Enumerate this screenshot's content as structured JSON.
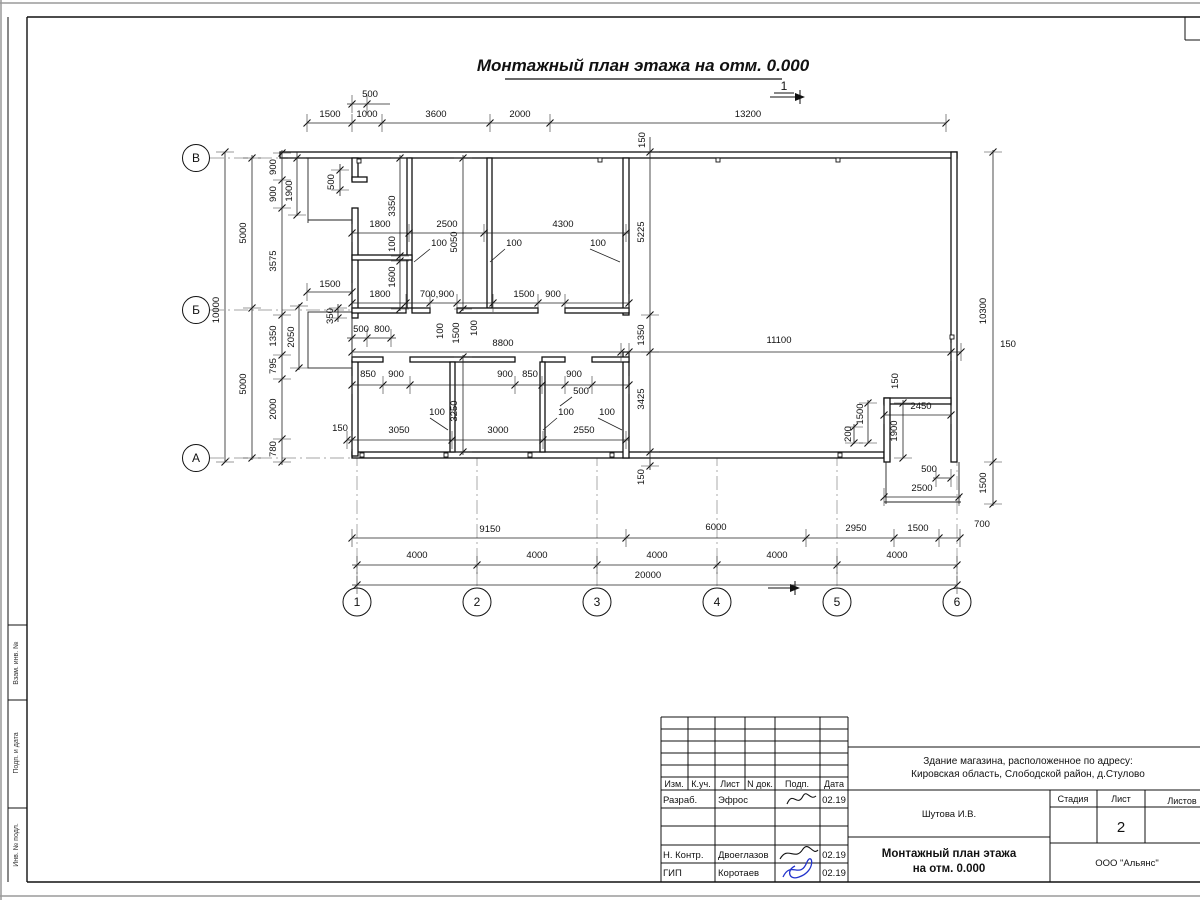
{
  "title": "Монтажный план этажа на отм. 0.000",
  "section_mark": "1",
  "axes": {
    "cols": [
      "1",
      "2",
      "3",
      "4",
      "5",
      "6"
    ],
    "rows": [
      "В",
      "Б",
      "А"
    ]
  },
  "dimensions": [
    {
      "t": "500",
      "x": 370,
      "y": 97,
      "v": false
    },
    {
      "t": "1500",
      "x": 330,
      "y": 117,
      "v": false
    },
    {
      "t": "1000",
      "x": 367,
      "y": 117,
      "v": false
    },
    {
      "t": "3600",
      "x": 436,
      "y": 117,
      "v": false
    },
    {
      "t": "2000",
      "x": 520,
      "y": 117,
      "v": false
    },
    {
      "t": "13200",
      "x": 748,
      "y": 117,
      "v": false
    },
    {
      "t": "150",
      "x": 645,
      "y": 140,
      "v": true
    },
    {
      "t": "10000",
      "x": 219,
      "y": 310,
      "v": true
    },
    {
      "t": "5000",
      "x": 246,
      "y": 233,
      "v": true
    },
    {
      "t": "5000",
      "x": 246,
      "y": 384,
      "v": true
    },
    {
      "t": "900",
      "x": 276,
      "y": 167,
      "v": true
    },
    {
      "t": "900",
      "x": 276,
      "y": 194,
      "v": true
    },
    {
      "t": "1900",
      "x": 292,
      "y": 191,
      "v": true
    },
    {
      "t": "3575",
      "x": 276,
      "y": 261,
      "v": true
    },
    {
      "t": "1350",
      "x": 276,
      "y": 336,
      "v": true
    },
    {
      "t": "795",
      "x": 276,
      "y": 366,
      "v": true
    },
    {
      "t": "2000",
      "x": 276,
      "y": 409,
      "v": true
    },
    {
      "t": "780",
      "x": 276,
      "y": 449,
      "v": true
    },
    {
      "t": "2050",
      "x": 294,
      "y": 337,
      "v": true
    },
    {
      "t": "1500",
      "x": 330,
      "y": 287,
      "v": false
    },
    {
      "t": "350",
      "x": 333,
      "y": 316,
      "v": true
    },
    {
      "t": "500",
      "x": 334,
      "y": 182,
      "v": true
    },
    {
      "t": "500",
      "x": 361,
      "y": 332,
      "v": false
    },
    {
      "t": "800",
      "x": 382,
      "y": 332,
      "v": false
    },
    {
      "t": "1800",
      "x": 380,
      "y": 227,
      "v": false
    },
    {
      "t": "2500",
      "x": 447,
      "y": 227,
      "v": false
    },
    {
      "t": "100",
      "x": 439,
      "y": 246,
      "v": false
    },
    {
      "t": "4300",
      "x": 563,
      "y": 227,
      "v": false
    },
    {
      "t": "100",
      "x": 514,
      "y": 246,
      "v": false
    },
    {
      "t": "100",
      "x": 598,
      "y": 246,
      "v": false
    },
    {
      "t": "3350",
      "x": 395,
      "y": 206,
      "v": true
    },
    {
      "t": "100",
      "x": 395,
      "y": 244,
      "v": true
    },
    {
      "t": "1600",
      "x": 395,
      "y": 277,
      "v": true
    },
    {
      "t": "5050",
      "x": 457,
      "y": 242,
      "v": true
    },
    {
      "t": "5225",
      "x": 644,
      "y": 232,
      "v": true
    },
    {
      "t": "1800",
      "x": 380,
      "y": 297,
      "v": false
    },
    {
      "t": "700,900",
      "x": 437,
      "y": 297,
      "v": false
    },
    {
      "t": "1500",
      "x": 524,
      "y": 297,
      "v": false
    },
    {
      "t": "900",
      "x": 553,
      "y": 297,
      "v": false
    },
    {
      "t": "100",
      "x": 443,
      "y": 331,
      "v": true
    },
    {
      "t": "1500",
      "x": 459,
      "y": 333,
      "v": true
    },
    {
      "t": "100",
      "x": 477,
      "y": 328,
      "v": true
    },
    {
      "t": "8800",
      "x": 503,
      "y": 346,
      "v": false
    },
    {
      "t": "11100",
      "x": 779,
      "y": 343,
      "v": false
    },
    {
      "t": "150",
      "x": 1008,
      "y": 347,
      "v": false
    },
    {
      "t": "1350",
      "x": 644,
      "y": 335,
      "v": true
    },
    {
      "t": "3425",
      "x": 644,
      "y": 399,
      "v": true
    },
    {
      "t": "150",
      "x": 644,
      "y": 477,
      "v": true
    },
    {
      "t": "10300",
      "x": 986,
      "y": 311,
      "v": true
    },
    {
      "t": "850",
      "x": 368,
      "y": 377,
      "v": false
    },
    {
      "t": "900",
      "x": 396,
      "y": 377,
      "v": false
    },
    {
      "t": "900",
      "x": 505,
      "y": 377,
      "v": false
    },
    {
      "t": "850",
      "x": 530,
      "y": 377,
      "v": false
    },
    {
      "t": "900",
      "x": 574,
      "y": 377,
      "v": false
    },
    {
      "t": "500",
      "x": 581,
      "y": 394,
      "v": false
    },
    {
      "t": "150",
      "x": 340,
      "y": 431,
      "v": false
    },
    {
      "t": "3050",
      "x": 399,
      "y": 433,
      "v": false
    },
    {
      "t": "100",
      "x": 437,
      "y": 415,
      "v": false
    },
    {
      "t": "3000",
      "x": 498,
      "y": 433,
      "v": false
    },
    {
      "t": "100",
      "x": 566,
      "y": 415,
      "v": false
    },
    {
      "t": "100",
      "x": 607,
      "y": 415,
      "v": false
    },
    {
      "t": "2550",
      "x": 584,
      "y": 433,
      "v": false
    },
    {
      "t": "3250",
      "x": 457,
      "y": 411,
      "v": true
    },
    {
      "t": "150",
      "x": 898,
      "y": 381,
      "v": true
    },
    {
      "t": "2450",
      "x": 921,
      "y": 409,
      "v": false
    },
    {
      "t": "1500",
      "x": 863,
      "y": 414,
      "v": true
    },
    {
      "t": "200",
      "x": 851,
      "y": 434,
      "v": true
    },
    {
      "t": "1900",
      "x": 897,
      "y": 431,
      "v": true
    },
    {
      "t": "500",
      "x": 929,
      "y": 472,
      "v": false
    },
    {
      "t": "2500",
      "x": 922,
      "y": 491,
      "v": false
    },
    {
      "t": "1500",
      "x": 986,
      "y": 483,
      "v": true
    },
    {
      "t": "2950",
      "x": 856,
      "y": 531,
      "v": false
    },
    {
      "t": "1500",
      "x": 918,
      "y": 531,
      "v": false
    },
    {
      "t": "700",
      "x": 982,
      "y": 527,
      "v": false
    },
    {
      "t": "9150",
      "x": 490,
      "y": 532,
      "v": false
    },
    {
      "t": "6000",
      "x": 716,
      "y": 530,
      "v": false
    },
    {
      "t": "4000",
      "x": 417,
      "y": 558,
      "v": false
    },
    {
      "t": "4000",
      "x": 537,
      "y": 558,
      "v": false
    },
    {
      "t": "4000",
      "x": 657,
      "y": 558,
      "v": false
    },
    {
      "t": "4000",
      "x": 777,
      "y": 558,
      "v": false
    },
    {
      "t": "4000",
      "x": 897,
      "y": 558,
      "v": false
    },
    {
      "t": "20000",
      "x": 648,
      "y": 578,
      "v": false
    }
  ],
  "title_block": {
    "header_cols": [
      "Изм.",
      "К.уч.",
      "Лист",
      "N док.",
      "Подп.",
      "Дата"
    ],
    "rows": [
      {
        "role": "Разраб.",
        "name": "Эфрос",
        "date": "02.19"
      },
      {
        "role": "Н. Контр.",
        "name": "Двоеглазов",
        "date": "02.19"
      },
      {
        "role": "ГИП",
        "name": "Коротаев",
        "date": "02.19"
      }
    ],
    "project_line1": "Здание магазина, расположенное по адресу:",
    "project_line2": "Кировская область, Слободской район, д.Стулово",
    "author": "Шутова И.В.",
    "stage_label": "Стадия",
    "sheet_label": "Лист",
    "sheets_label": "Листов",
    "sheet_number": "2",
    "drawing_title_line1": "Монтажный план этажа",
    "drawing_title_line2": "на отм. 0.000",
    "company": "ООО \"Альянс\""
  },
  "side_column": [
    "Взам. инв. №",
    "Подп. и дата",
    "Инв. № подл."
  ]
}
